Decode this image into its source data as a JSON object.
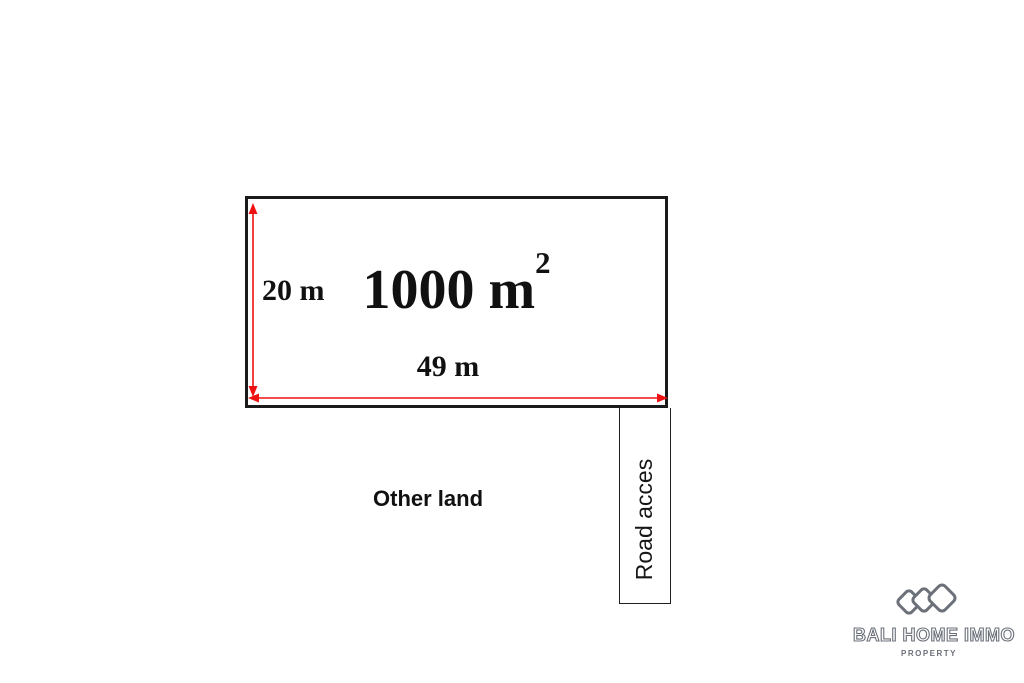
{
  "diagram": {
    "plot": {
      "area_value": "1000 m",
      "area_exponent": "2",
      "width_label": "49 m",
      "height_label": "20 m"
    },
    "other_land_label": "Other land",
    "road_access_label": "Road acces"
  },
  "branding": {
    "company_name": "BALI HOME IMMO",
    "tagline": "PROPERTY"
  },
  "colors": {
    "arrow": "#ee1111",
    "border": "#1a1a1a",
    "logo": "#6b7079"
  }
}
